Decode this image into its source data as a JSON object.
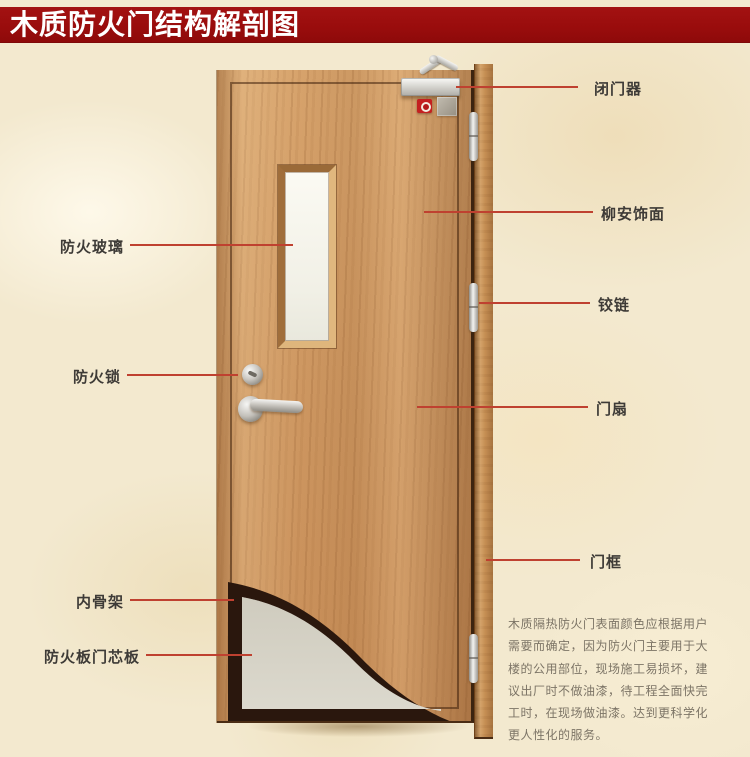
{
  "title": "木质防火门结构解剖图",
  "labels": {
    "left": [
      {
        "id": "fire-glass",
        "text": "防火玻璃"
      },
      {
        "id": "fire-lock",
        "text": "防火锁"
      },
      {
        "id": "inner-skeleton",
        "text": "内骨架"
      },
      {
        "id": "core-board",
        "text": "防火板门芯板"
      }
    ],
    "right": [
      {
        "id": "door-closer",
        "text": "闭门器"
      },
      {
        "id": "lauan-veneer",
        "text": "柳安饰面"
      },
      {
        "id": "hinge",
        "text": "铰链"
      },
      {
        "id": "door-leaf",
        "text": "门扇"
      },
      {
        "id": "door-frame",
        "text": "门框"
      }
    ]
  },
  "description_lines": [
    "木质隔热防火门表面颜色应根据用户",
    "需要而确定，因为防火门主要用于大",
    "楼的公用部位，现场施工易损坏，建",
    "议出厂时不做油漆，待工程全面快完",
    "工时，在现场做油漆。达到更科学化",
    "更人性化的服务。"
  ],
  "colors": {
    "title_bar": "#990c0c",
    "title_text": "#ffffff",
    "background": "#f3e9cf",
    "pointer_line": "#bf4130",
    "label_text": "#3e3b37",
    "description_text": "#7c7466",
    "door_wood": "#cd9660",
    "door_frame_wood": "#c68f54",
    "core_board_gray": "#d6d3c7",
    "inner_skeleton_dark": "#2a170d",
    "glass": "#f7f6ee"
  }
}
